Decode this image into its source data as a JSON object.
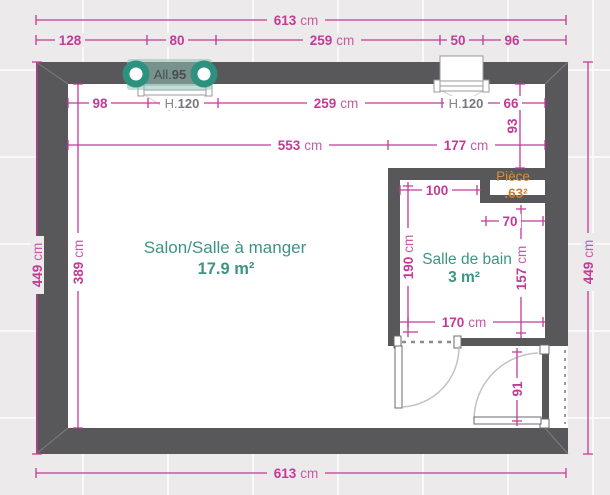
{
  "colors": {
    "dimension": "#C13B97",
    "wall": "#585759",
    "room_label": "#3F9384",
    "annotation_gray": "#85848A",
    "piece_label": "#DC8F33",
    "window_accent": "#2E9180",
    "background": "#ECEAEA"
  },
  "rooms": {
    "salon": {
      "name": "Salon/Salle à manger",
      "area": "17.9 m²"
    },
    "bathroom": {
      "name": "Salle de bain",
      "area": "3 m²"
    },
    "piece": {
      "name": "Pièce",
      "area": ".63²"
    }
  },
  "window": {
    "label": {
      "prefix": "All.",
      "v": "95"
    },
    "height_left": {
      "prefix": "H.",
      "v": "120"
    },
    "height_right": {
      "prefix": "H.",
      "v": "120"
    }
  },
  "dims": {
    "top_total": {
      "v": "613",
      "u": "cm"
    },
    "top_seg_1": {
      "v": "128",
      "u": ""
    },
    "top_seg_2": {
      "v": "80",
      "u": ""
    },
    "top_seg_3": {
      "v": "259",
      "u": "cm"
    },
    "top_seg_4": {
      "v": "50",
      "u": ""
    },
    "top_seg_5": {
      "v": "96",
      "u": ""
    },
    "inner_top_1": {
      "v": "98",
      "u": ""
    },
    "inner_top_2": {
      "v": "259",
      "u": "cm"
    },
    "inner_top_3": {
      "v": "66",
      "u": ""
    },
    "salon_width": {
      "v": "553",
      "u": "cm"
    },
    "bath_outer_width": {
      "v": "177",
      "u": "cm"
    },
    "right_inset": {
      "v": "93",
      "u": ""
    },
    "left_total": {
      "v": "449",
      "u": "cm"
    },
    "salon_height": {
      "v": "389",
      "u": "cm"
    },
    "right_total": {
      "v": "449",
      "u": "cm"
    },
    "bottom_total": {
      "v": "613",
      "u": "cm"
    },
    "bath_top": {
      "v": "100",
      "u": ""
    },
    "niche_width": {
      "v": "70",
      "u": ""
    },
    "bath_left_height": {
      "v": "190",
      "u": "cm"
    },
    "bath_right_height": {
      "v": "157",
      "u": "cm"
    },
    "bath_bottom": {
      "v": "170",
      "u": "cm"
    },
    "entry_door": {
      "v": "91",
      "u": ""
    }
  }
}
